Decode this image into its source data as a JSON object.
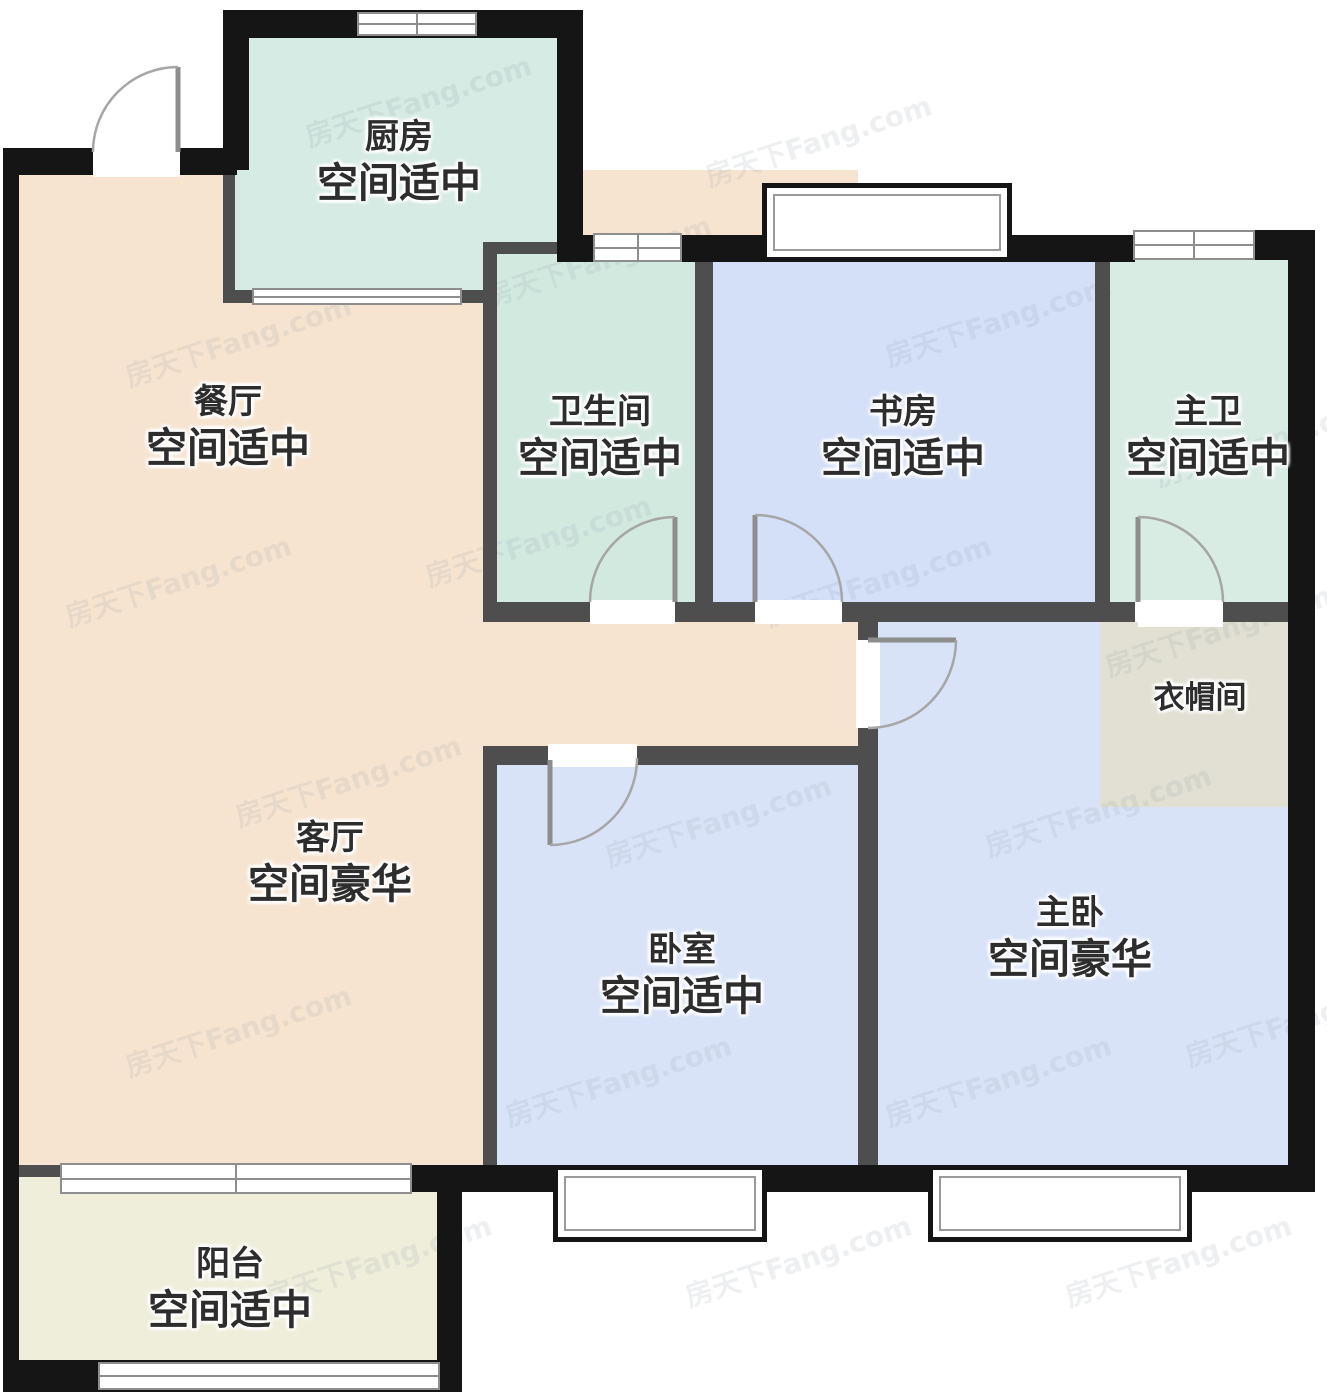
{
  "watermark": {
    "text": "房天下Fang.com"
  },
  "rooms": {
    "kitchen": {
      "name": "厨房",
      "status": "空间适中"
    },
    "dining": {
      "name": "餐厅",
      "status": "空间适中"
    },
    "bathroom": {
      "name": "卫生间",
      "status": "空间适中"
    },
    "study": {
      "name": "书房",
      "status": "空间适中"
    },
    "master_bath": {
      "name": "主卫",
      "status": "空间适中"
    },
    "closet": {
      "name": "衣帽间"
    },
    "living": {
      "name": "客厅",
      "status": "空间豪华"
    },
    "bedroom": {
      "name": "卧室",
      "status": "空间适中"
    },
    "master_bedroom": {
      "name": "主卧",
      "status": "空间豪华"
    },
    "balcony": {
      "name": "阳台",
      "status": "空间适中"
    }
  },
  "colors": {
    "outer_wall": "#151515",
    "interior_wall": "#4e4e4e",
    "kitchen": "#d5ebe3",
    "bathroom": "#d2e9e0",
    "master_bath": "#d8ece4",
    "dining_living": "#f7e4d0",
    "study": "#d3e0f7",
    "bedroom": "#d8e3f8",
    "master_bedroom": "#d8e3f8",
    "closet": "#e1e0d2",
    "balcony": "#efeeda",
    "label_text": "#2d2d2d"
  }
}
